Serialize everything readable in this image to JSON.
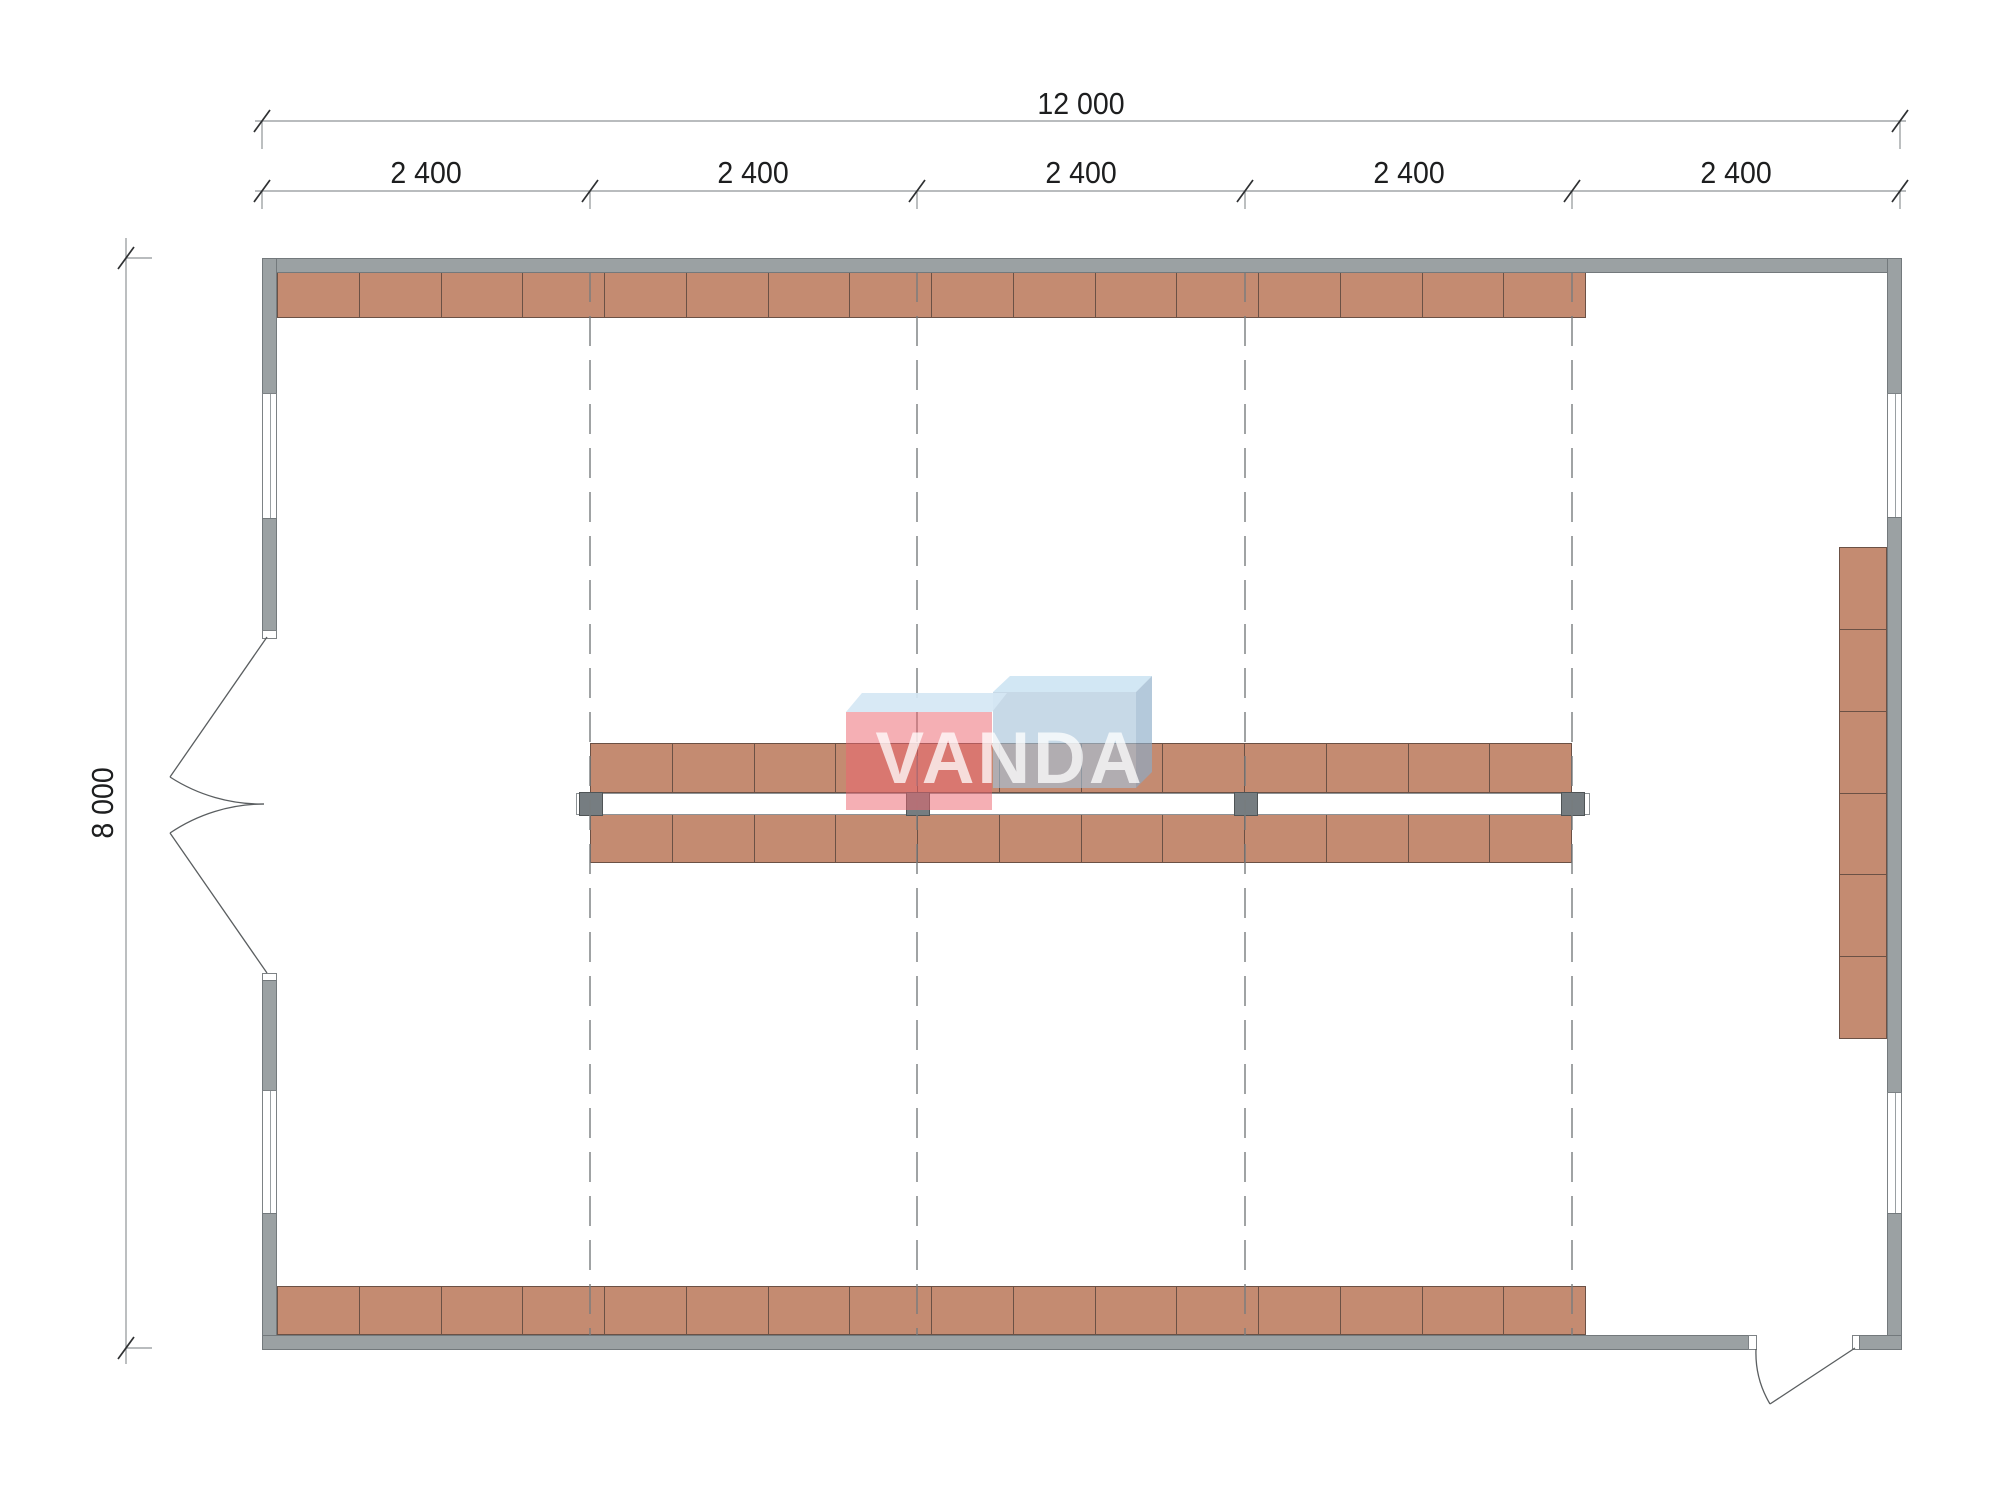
{
  "watermark": {
    "text": "VANDA"
  },
  "dimensions": {
    "total_width": {
      "label": "12 000"
    },
    "segments": [
      {
        "label": "2 400"
      },
      {
        "label": "2 400"
      },
      {
        "label": "2 400"
      },
      {
        "label": "2 400"
      },
      {
        "label": "2 400"
      }
    ],
    "total_height": {
      "label": "8 000"
    }
  },
  "shelving": {
    "top_row": {
      "units": 16
    },
    "bottom_row": {
      "units": 16
    },
    "center_top_row": {
      "units": 12
    },
    "center_bottom_row": {
      "units": 12
    },
    "right_column": {
      "units": 6
    }
  },
  "structure": {
    "grid_lines": 4,
    "windows": 4,
    "doors": 2,
    "posts": 4
  },
  "colors": {
    "shelf_fill": "#c48b71",
    "shelf_border": "#6b5145",
    "wall_fill": "#9ba1a3",
    "wall_edge": "#73797c",
    "grid_line": "#777c7e",
    "dimension_line": "#8f9496",
    "dimension_text": "#1d1e1f",
    "post_fill": "#767d81",
    "logo_red": "#ed6a75",
    "logo_blue": "#a4c1d8",
    "logo_top": "#cde4f3"
  }
}
